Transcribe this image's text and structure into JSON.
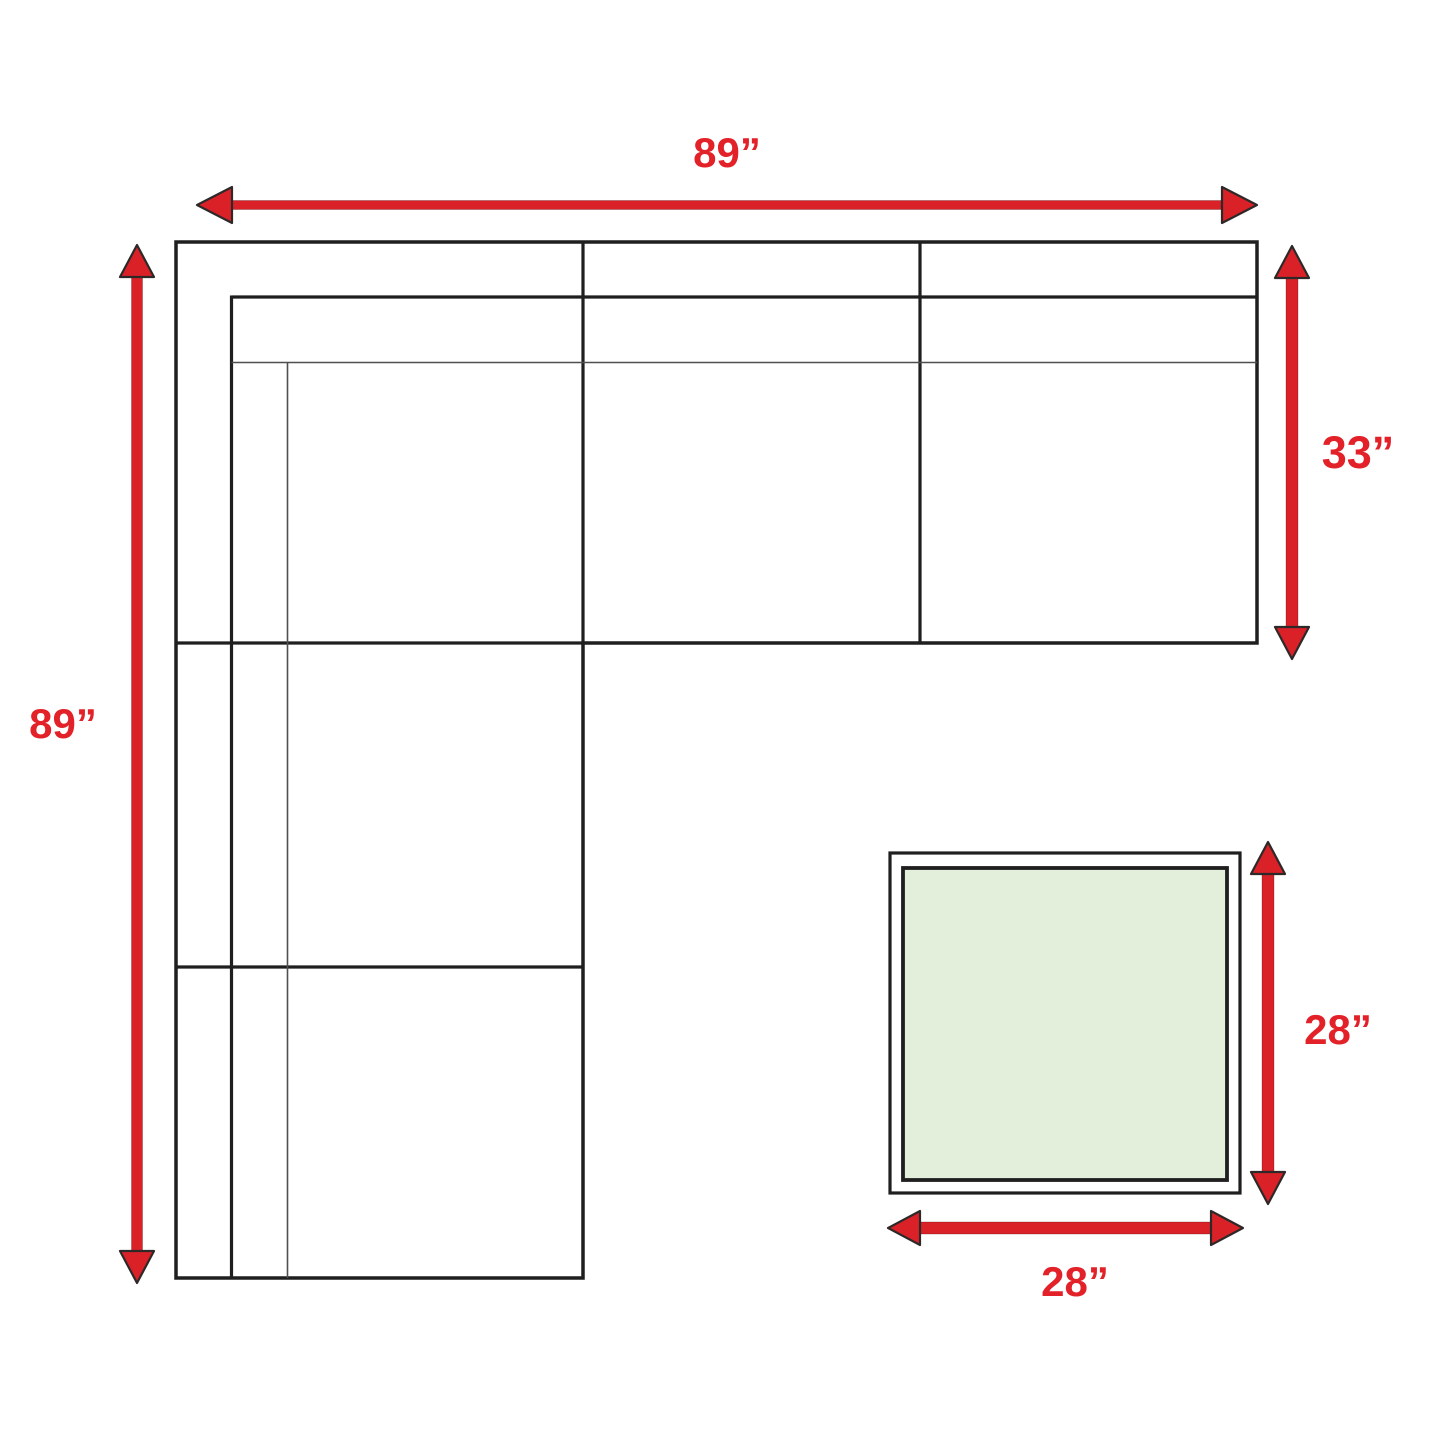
{
  "measurements": {
    "sofa_width": "89”",
    "sofa_height": "89”",
    "sofa_right_depth": "33”",
    "ottoman_height": "28”",
    "ottoman_width": "28”"
  },
  "colors": {
    "arrow_red": "#da2128",
    "label_red": "#e22129",
    "outline_black": "#1f1f1f",
    "thin_line_gray": "#4f4f4f",
    "ottoman_fill_green": "#e3efda",
    "background": "#ffffff"
  }
}
